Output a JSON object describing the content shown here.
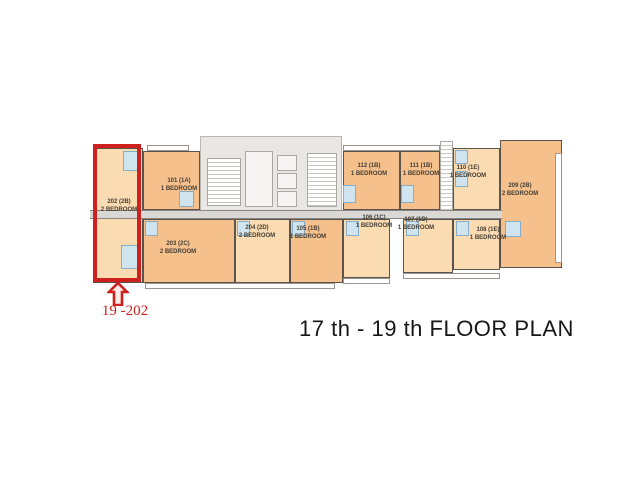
{
  "title": "17 th - 19 th FLOOR PLAN",
  "annotation": {
    "unit_callout": "19 -202"
  },
  "colors": {
    "highlight_red": "#ce201d",
    "unit_orange": "#f5c08c",
    "unit_peach": "#fbdcb2",
    "bathroom_blue": "#cfe4ef",
    "core_gray": "#e8e7e4",
    "corridor_gray": "#d9d8d4"
  },
  "plan": {
    "units": [
      {
        "number": "202 (2B)",
        "type": "2 BEDROOM",
        "highlighted": true
      },
      {
        "number": "101 (1A)",
        "type": "1 BEDROOM",
        "highlighted": false
      },
      {
        "number": "112 (1B)",
        "type": "1 BEDROOM",
        "highlighted": false
      },
      {
        "number": "111 (1B)",
        "type": "1 BEDROOM",
        "highlighted": false
      },
      {
        "number": "110 (1E)",
        "type": "1 BEDROOM",
        "highlighted": false
      },
      {
        "number": "209 (2B)",
        "type": "2 BEDROOM",
        "highlighted": false
      },
      {
        "number": "203 (2C)",
        "type": "2 BEDROOM",
        "highlighted": false
      },
      {
        "number": "204 (2D)",
        "type": "2 BEDROOM",
        "highlighted": false
      },
      {
        "number": "105 (1B)",
        "type": "1 BEDROOM",
        "highlighted": false
      },
      {
        "number": "106 (1C)",
        "type": "1 BEDROOM",
        "highlighted": false
      },
      {
        "number": "107 (1D)",
        "type": "1 BEDROOM",
        "highlighted": false
      },
      {
        "number": "108 (1E)",
        "type": "1 BEDROOM",
        "highlighted": false
      }
    ]
  }
}
